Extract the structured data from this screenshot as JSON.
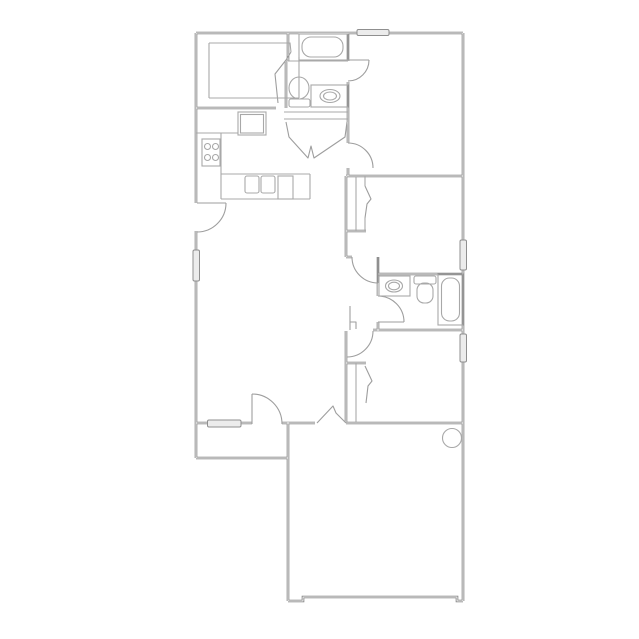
{
  "title": "floor-plan",
  "colors": {
    "background": "#ffffff",
    "wall": "#7d7d7d",
    "wall_fill": "#f5f5f5",
    "fixture": "#a8a8a8",
    "door": "#9e9e9e",
    "window_fill": "#ececec",
    "window_stroke": "#8f8f8f"
  },
  "rooms": [
    {
      "name": "dining-room"
    },
    {
      "name": "kitchen"
    },
    {
      "name": "bathroom-1"
    },
    {
      "name": "bedroom-1"
    },
    {
      "name": "bedroom-2"
    },
    {
      "name": "bathroom-2"
    },
    {
      "name": "bedroom-3"
    },
    {
      "name": "living-room"
    },
    {
      "name": "hall-alcove"
    },
    {
      "name": "entry-porch"
    },
    {
      "name": "garage"
    }
  ],
  "fixtures": [
    {
      "name": "bathtub-1"
    },
    {
      "name": "toilet-1"
    },
    {
      "name": "sink-vanity-1"
    },
    {
      "name": "refrigerator"
    },
    {
      "name": "range-stove"
    },
    {
      "name": "kitchen-double-sink"
    },
    {
      "name": "dishwasher"
    },
    {
      "name": "sink-vanity-2"
    },
    {
      "name": "toilet-2"
    },
    {
      "name": "bathtub-2"
    },
    {
      "name": "water-heater"
    },
    {
      "name": "closet-rod-bedroom-2"
    },
    {
      "name": "closet-rod-bedroom-3"
    }
  ],
  "counts": {
    "windows": 5,
    "door-swings": 12,
    "closets": 2,
    "garage-door-openings": 1
  }
}
